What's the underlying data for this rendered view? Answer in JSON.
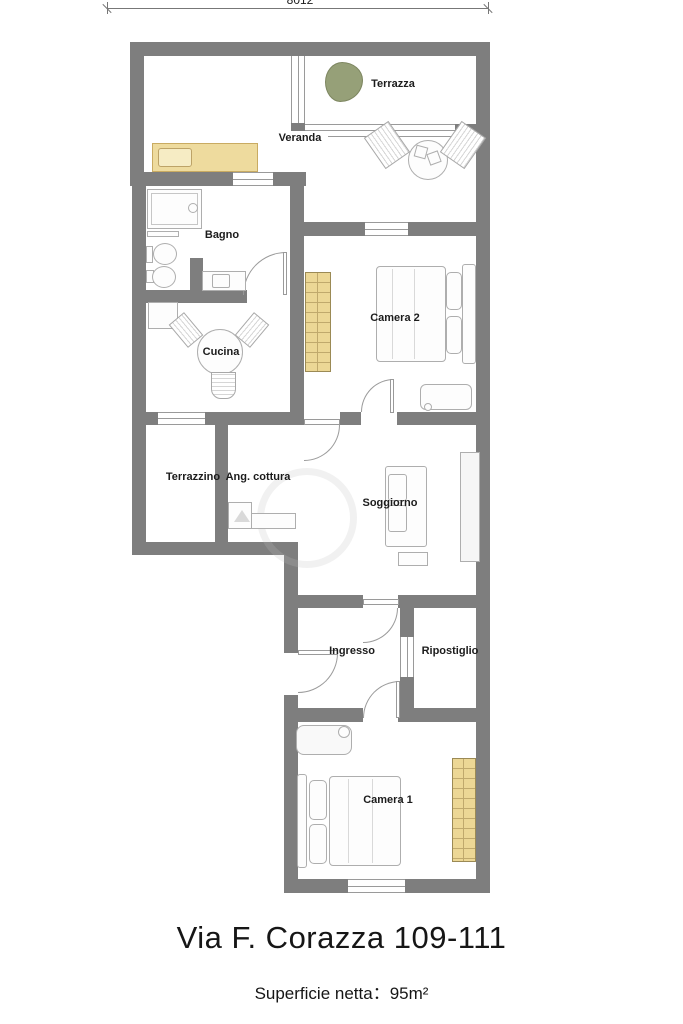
{
  "plan": {
    "dimension_top": "8012",
    "rooms": {
      "terrazza": {
        "label": "Terrazza"
      },
      "veranda": {
        "label": "Veranda"
      },
      "bagno": {
        "label": "Bagno"
      },
      "camera2": {
        "label": "Camera 2"
      },
      "cucina": {
        "label": "Cucina"
      },
      "terrazzino": {
        "label": "Terrazzino"
      },
      "ang_cottura": {
        "label": "Ang. cottura"
      },
      "soggiorno": {
        "label": "Soggiorno"
      },
      "ingresso": {
        "label": "Ingresso"
      },
      "ripostiglio": {
        "label": "Ripostiglio"
      },
      "camera1": {
        "label": "Camera 1"
      }
    },
    "colors": {
      "wall": "#7e7e7e",
      "wardrobe_fill": "#ecd795",
      "plant": "#96a078"
    }
  },
  "footer": {
    "address": "Via F. Corazza 109-111",
    "area": "Superficie netta：95m²"
  }
}
